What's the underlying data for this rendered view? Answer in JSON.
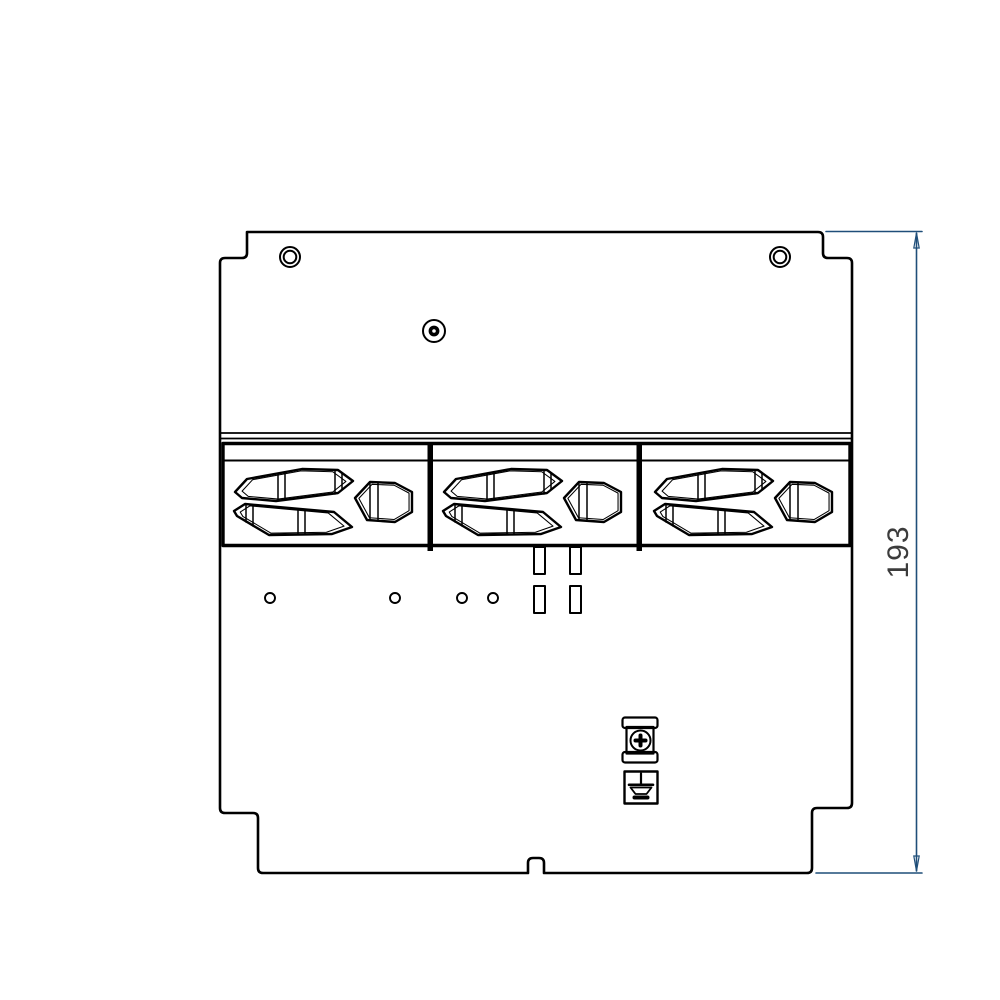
{
  "drawing": {
    "background": "#ffffff",
    "stroke_color": "#000000",
    "dimension": {
      "value": "193",
      "line_color": "#1f4e79",
      "text_color": "#3c3c3c"
    },
    "parts": {
      "plate": "mounting-plate",
      "top_holes": [
        "screw-hole-left",
        "screw-hole-right"
      ],
      "center_hole": "countersunk-hole",
      "connector_blocks": 3,
      "cutouts_per_block": 3,
      "small_holes": 4,
      "slots": 4,
      "screw_terminal": "earth-screw-terminal",
      "ground_symbol": "earth-ground-symbol"
    }
  }
}
